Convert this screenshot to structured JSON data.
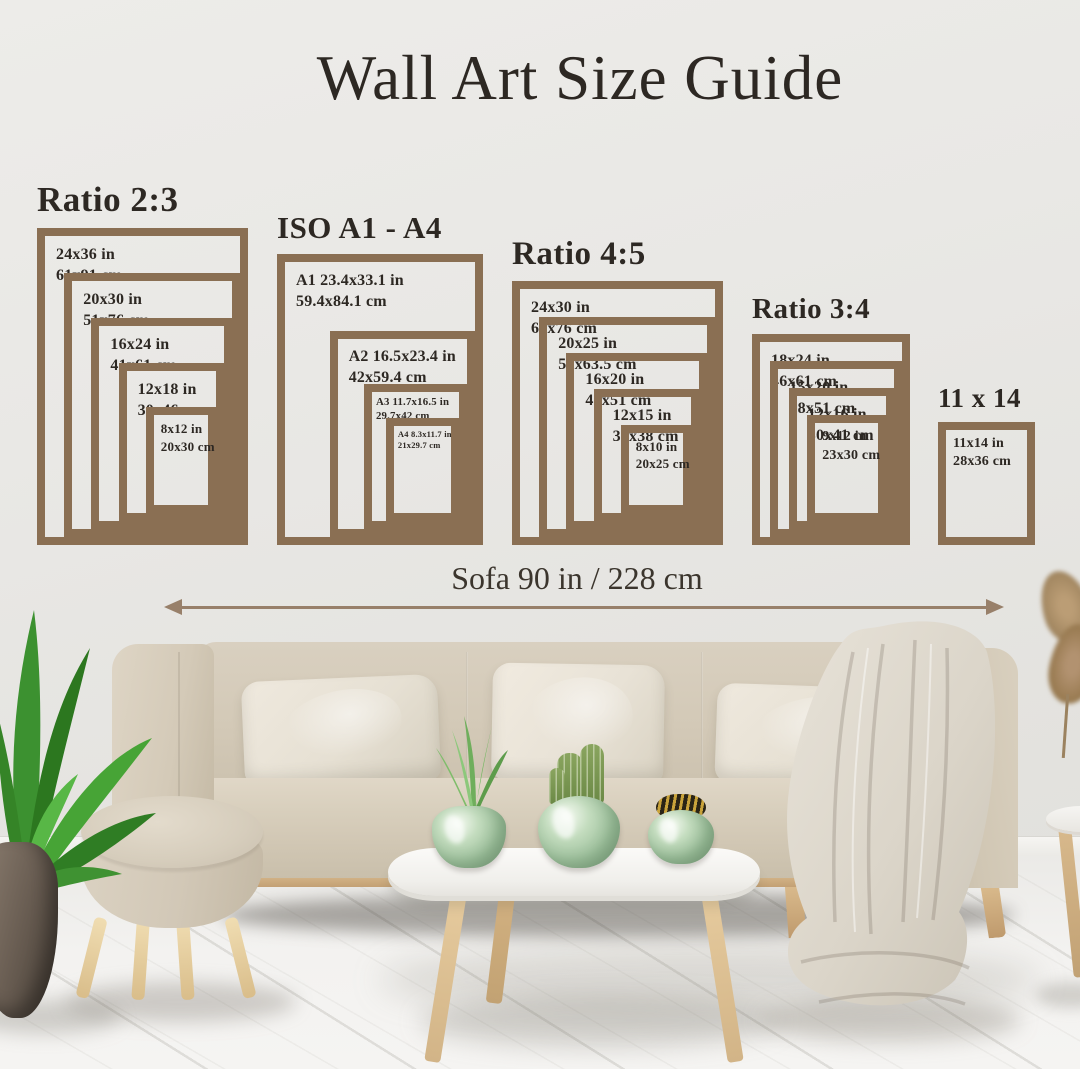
{
  "title": "Wall Art Size Guide",
  "sofa_measurement": {
    "label": "Sofa 90 in / 228 cm"
  },
  "colors": {
    "frame_border": "#8a6f53",
    "heading_text": "#2d2823",
    "arrow": "#98806a",
    "wall": "#e8e7e4"
  },
  "groups": [
    {
      "id": "ratio-2-3",
      "title": "Ratio 2:3",
      "frames": [
        {
          "in": "24x36 in",
          "cm": "61x91 cm",
          "w": 24,
          "h": 36
        },
        {
          "in": "20x30 in",
          "cm": "51x76 cm",
          "w": 20,
          "h": 30
        },
        {
          "in": "16x24 in",
          "cm": "41x61 cm",
          "w": 16,
          "h": 24
        },
        {
          "in": "12x18 in",
          "cm": "30x46 cm",
          "w": 12,
          "h": 18
        },
        {
          "in": "8x12 in",
          "cm": "20x30 cm",
          "w": 8,
          "h": 12
        }
      ]
    },
    {
      "id": "iso-a1-a4",
      "title": "ISO A1 - A4",
      "frames": [
        {
          "in": "A1 23.4x33.1 in",
          "cm": "59.4x84.1 cm",
          "w": 23.4,
          "h": 33.1
        },
        {
          "in": "A2 16.5x23.4 in",
          "cm": "42x59.4 cm",
          "w": 16.5,
          "h": 23.4
        },
        {
          "in": "A3 11.7x16.5 in",
          "cm": "29.7x42 cm",
          "w": 11.7,
          "h": 16.5
        },
        {
          "in": "A4 8.3x11.7 in",
          "cm": "21x29.7 cm",
          "w": 8.3,
          "h": 11.7
        }
      ]
    },
    {
      "id": "ratio-4-5",
      "title": "Ratio 4:5",
      "frames": [
        {
          "in": "24x30 in",
          "cm": "61x76 cm",
          "w": 24,
          "h": 30
        },
        {
          "in": "20x25 in",
          "cm": "51x63.5 cm",
          "w": 20,
          "h": 25
        },
        {
          "in": "16x20 in",
          "cm": "41x51 cm",
          "w": 16,
          "h": 20
        },
        {
          "in": "12x15 in",
          "cm": "30x38 cm",
          "w": 12,
          "h": 15
        },
        {
          "in": "8x10 in",
          "cm": "20x25 cm",
          "w": 8,
          "h": 10
        }
      ]
    },
    {
      "id": "ratio-3-4",
      "title": "Ratio 3:4",
      "frames": [
        {
          "in": "18x24 in",
          "cm": "46x61 cm",
          "w": 18,
          "h": 24
        },
        {
          "in": "15x20 in",
          "cm": "38x51 cm",
          "w": 15,
          "h": 20
        },
        {
          "in": "12x16 in",
          "cm": "30x41 cm",
          "w": 12,
          "h": 16
        },
        {
          "in": "9x12 in",
          "cm": "23x30 cm",
          "w": 9,
          "h": 12
        }
      ]
    },
    {
      "id": "size-11x14",
      "title": "11 x 14",
      "frames": [
        {
          "in": "11x14 in",
          "cm": "28x36 cm",
          "w": 11,
          "h": 14
        }
      ]
    }
  ]
}
